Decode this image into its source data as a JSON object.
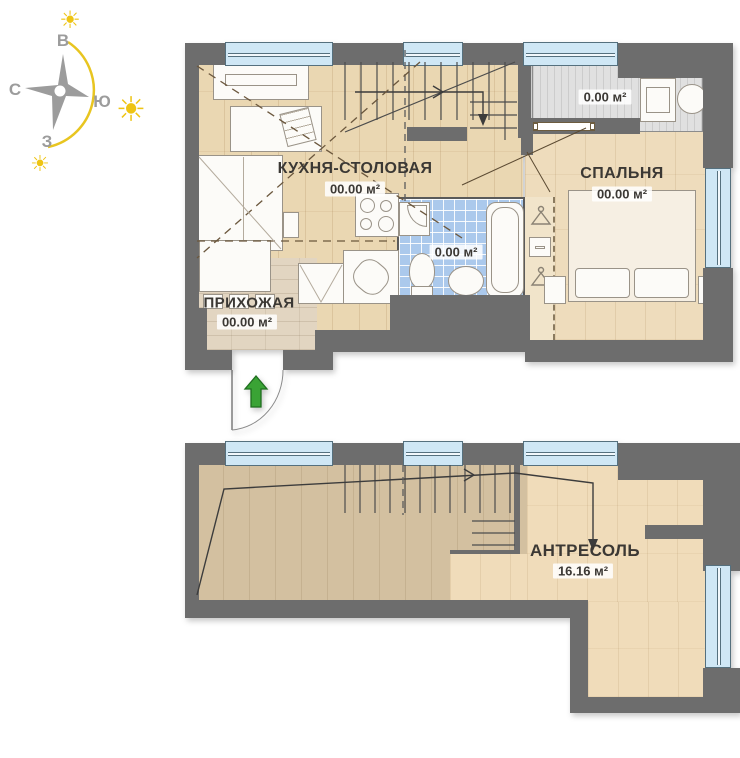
{
  "compass": {
    "letters": {
      "top": "В",
      "left": "С",
      "right": "Ю",
      "bottom": "З"
    }
  },
  "icons": {
    "sun": "☀"
  },
  "floor1": {
    "kitchen": {
      "name": "КУХНЯ-СТОЛОВАЯ",
      "area": "00.00 м²"
    },
    "bedroom": {
      "name": "СПАЛЬНЯ",
      "area": "00.00 м²"
    },
    "hallway": {
      "name": "ПРИХОЖАЯ",
      "area": "00.00 м²"
    },
    "bathroom": {
      "area": "0.00 м²"
    },
    "laundry": {
      "area": "0.00 м²"
    }
  },
  "floor2": {
    "mezzanine": {
      "name": "АНТРЕСОЛЬ",
      "area": "16.16 м²"
    }
  },
  "colors": {
    "wall": "#6d6d6d",
    "window_glass": "#cfe7f5",
    "bath_tile": "#abc9ec",
    "wood_light": "#ead7b2",
    "wood_dark": "#d3c0a0",
    "entry_green": "#3aa335",
    "sun_yellow": "#eec414",
    "compass_gray": "#9c9c9c"
  }
}
